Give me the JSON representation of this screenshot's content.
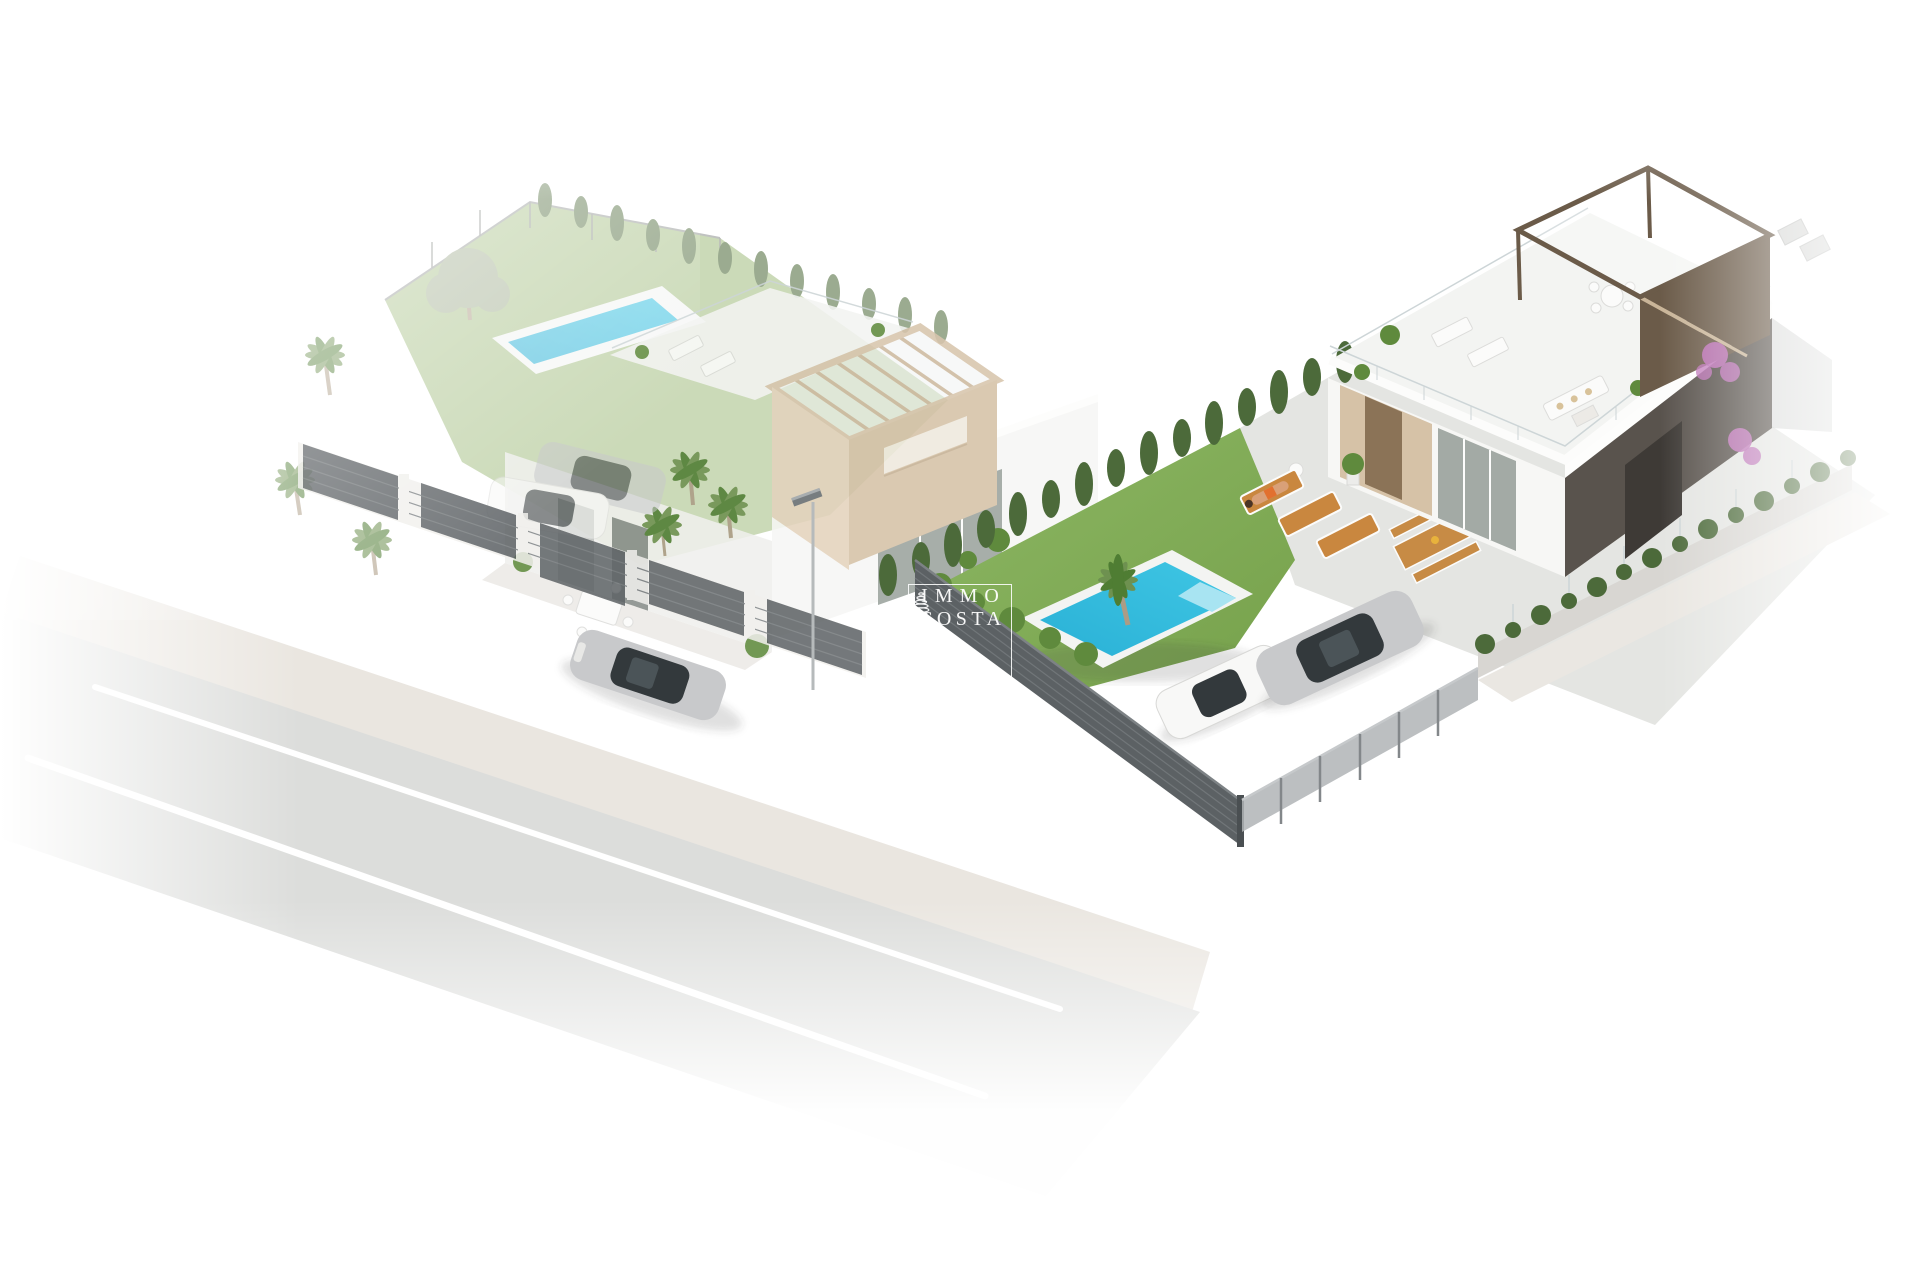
{
  "image": {
    "type": "3d-architectural-render",
    "description": "Aerial isometric rendering of two modern white villas on a corner plot: left two-storey villa with beige rooftop pergola, lap pool and mature garden; right single-storey villa with large roof solarium, wooden pergola, turquoise pool, lawn, sun loungers and parked cars; grey slatted street fences, sidewalk and road with a silver car; scene fades to white at the edges",
    "background": "#ffffff"
  },
  "watermark": {
    "line1": "IMMO",
    "line2": "COSTA",
    "icon": "cypress-spiral-icon",
    "color": "rgba(255,255,255,0.95)"
  },
  "colors": {
    "background": "#ffffff",
    "road": "#dcdddb",
    "road_dark": "#cfd0ce",
    "road_marking": "#ffffff",
    "sidewalk": "#eae6e0",
    "lawn_left": "#a9c289",
    "lawn_right": "#8db764",
    "lawn_right_deep": "#76a14b",
    "pool_water": "#3fc6e4",
    "pool_water_deep": "#2ab1d6",
    "pool_water_light": "#a8e4f2",
    "pool_deck": "#f3f4f2",
    "hedge": "#4c6a3a",
    "cypress": "#5a7547",
    "olive": "#a2b092",
    "palm": "#6e9150",
    "palm_dark": "#4f7d33",
    "trunk": "#ac9c85",
    "fence_dark": "#5c6164",
    "fence_slat_line": "#74797c",
    "fence_light": "#b0b4b6",
    "fence_white": "#f1f0ed",
    "villa_white": "#f7f7f5",
    "villa_shade": "#f0f0ed",
    "villa_fascia": "#fdfdfc",
    "pergola_beige": "#e4d3bd",
    "pergola_tan": "#d5c2a7",
    "beam": "#cdbaa0",
    "wood_pergola": "#6b5b49",
    "wood_beam_light": "#c9b599",
    "dark_wall": "#59534d",
    "dark_door": "#3e3a36",
    "wood_door": "#8b7357",
    "wood_clad": "#d6c2a7",
    "glass": "#a3aaa5",
    "glass_dark": "#9ba39e",
    "rail_glass": "#cdd5d7",
    "car_silver": "#c8c9cb",
    "car_glass": "#33393c",
    "car_white": "#f8f8f7",
    "lounger_wood": "#c9873f",
    "picnic_wood": "#c78b45",
    "skin": "#d9a078",
    "swimsuit": "#e2702f",
    "bougainvillea": "#bb6fb5",
    "plant_green": "#5f8a3d",
    "watermark": "rgba(255,255,255,0.95)"
  },
  "objects": [
    "road",
    "road-lane-markings",
    "sidewalk",
    "street-lamp",
    "driving-silver-car",
    "left-plot-lawn",
    "left-plot-lap-pool",
    "left-plot-cypress-row",
    "olive-tree",
    "palm-trees",
    "left-villa",
    "left-villa-roof-pergola",
    "left-villa-roof-terrace",
    "left-villa-dining-set",
    "left-plot-street-fence",
    "left-plot-parked-cars",
    "dividing-cypress-hedge",
    "right-plot-lawn",
    "right-plot-pool",
    "right-plot-terrace",
    "sun-loungers",
    "sunbathing-person",
    "picnic-table",
    "right-villa",
    "right-villa-roof-solarium",
    "right-villa-wood-pergola",
    "bougainvillea",
    "right-plot-dark-fence",
    "right-plot-gate-fence",
    "right-boundary-hedge",
    "parked-silver-coupe",
    "parked-white-car"
  ]
}
